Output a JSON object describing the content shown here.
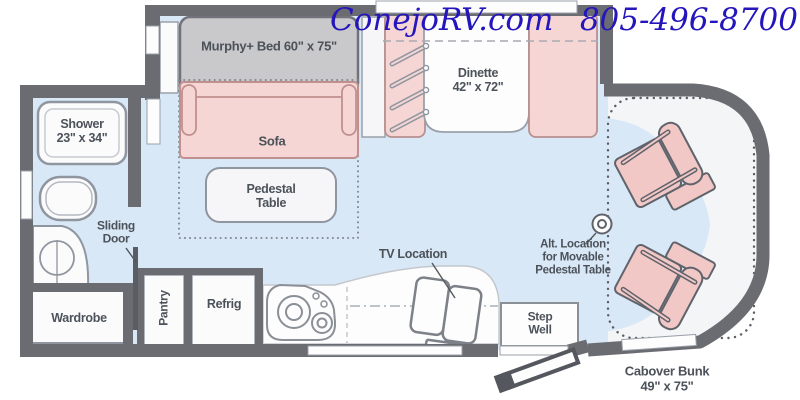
{
  "header": {
    "brand": "ConejoRV.com",
    "phone": "805-496-8700"
  },
  "floorplan": {
    "murphy_bed": "Murphy+ Bed 60\" x 75\"",
    "sofa": "Sofa",
    "dinette": "Dinette\n42\" x 72\"",
    "pedestal_table": "Pedestal\nTable",
    "shower": "Shower\n23\" x 34\"",
    "sliding_door": "Sliding\nDoor",
    "wardrobe": "Wardrobe",
    "pantry": "Pantry",
    "refrig": "Refrig",
    "tv_location": "TV Location",
    "step_well": "Step\nWell",
    "alt_location": "Alt. Location\nfor Movable\nPedestal Table",
    "cabover_bunk": "Cabover Bunk\n49\" x 75\""
  },
  "colors": {
    "header_text": "#2415bc",
    "wall": "#6b6b72",
    "floor_blue": "#d9e8f7",
    "furniture_pink": "#f6d6d4",
    "furniture_pink_outline": "#c0908e",
    "seat_pink": "#f2c8c6",
    "bed_gray": "#c9c8cb",
    "fixture_white": "#fdfdfe",
    "fixture_outline": "#9096a0",
    "label_text": "#4c525a"
  }
}
